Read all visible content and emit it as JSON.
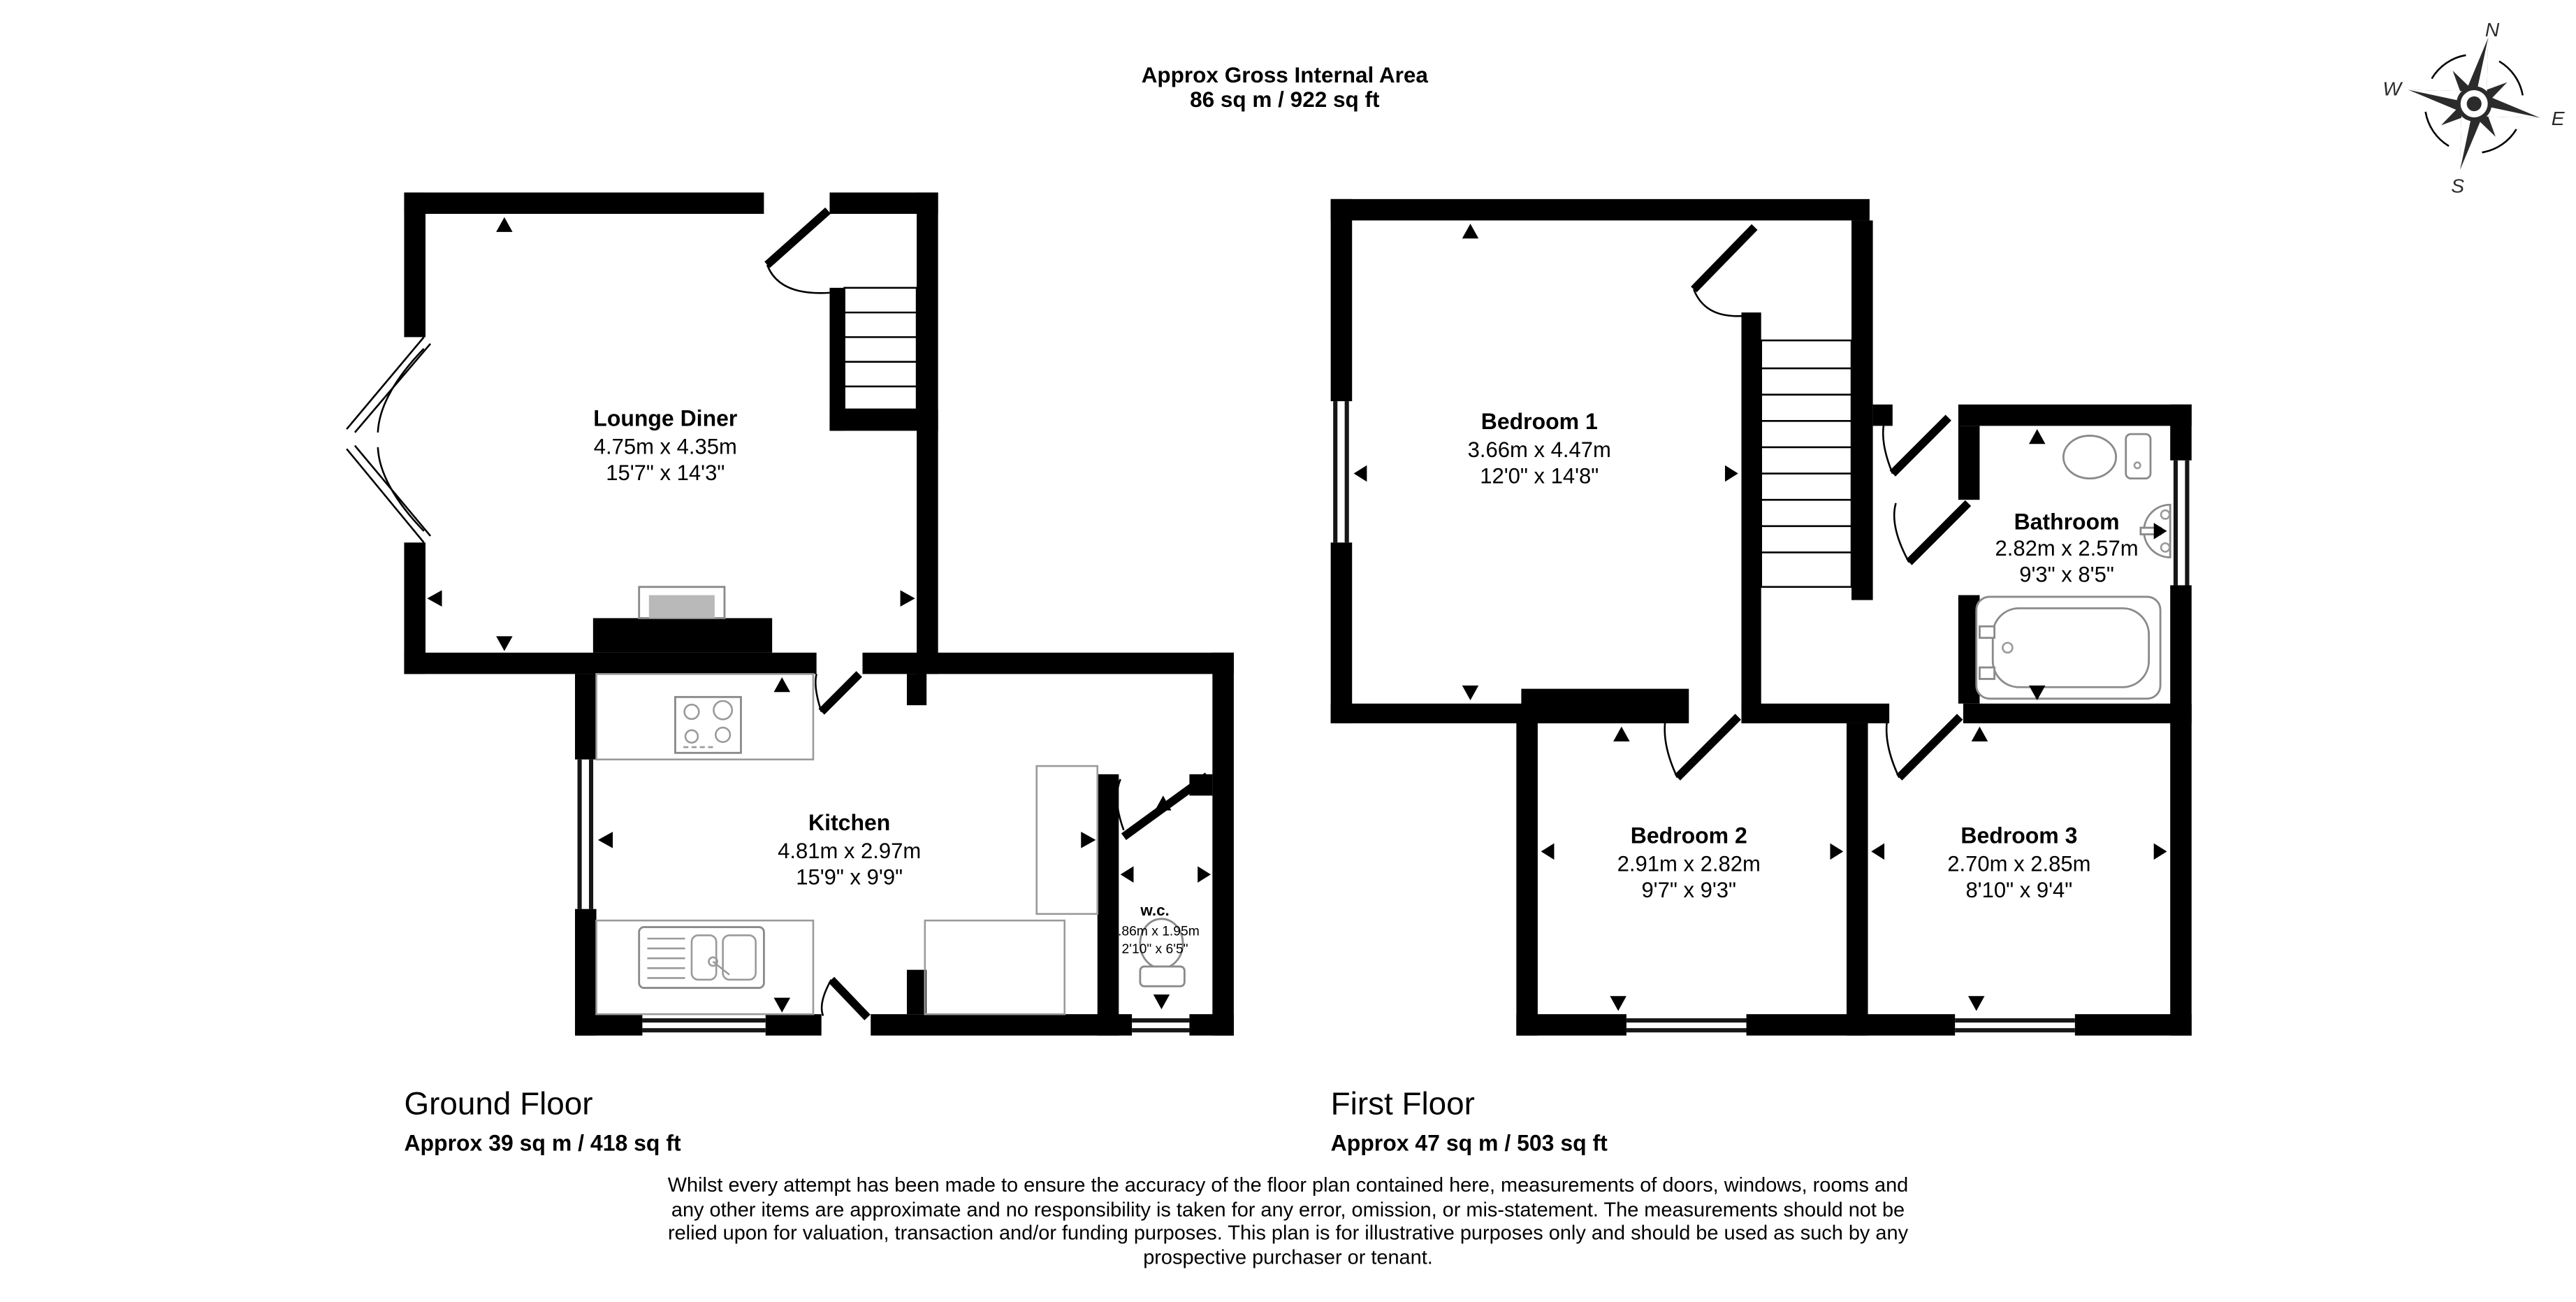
{
  "title": {
    "line1": "Approx Gross Internal Area",
    "line2": "86 sq m / 922 sq ft"
  },
  "compass": {
    "north": "N",
    "east": "E",
    "south": "S",
    "west": "W"
  },
  "ground_floor": {
    "label": "Ground Floor",
    "area": "Approx 39 sq m / 418 sq ft",
    "rooms": {
      "lounge_diner": {
        "name": "Lounge Diner",
        "size_metric": "4.75m x 4.35m",
        "size_imperial": "15'7\" x 14'3\""
      },
      "kitchen": {
        "name": "Kitchen",
        "size_metric": "4.81m x 2.97m",
        "size_imperial": "15'9\" x 9'9\""
      },
      "wc": {
        "name": "w.c.",
        "size_metric": "0.86m x 1.95m",
        "size_imperial": "2'10\" x 6'5\""
      }
    }
  },
  "first_floor": {
    "label": "First Floor",
    "area": "Approx 47 sq m / 503 sq ft",
    "rooms": {
      "bedroom1": {
        "name": "Bedroom 1",
        "size_metric": "3.66m x 4.47m",
        "size_imperial": "12'0\" x 14'8\""
      },
      "bathroom": {
        "name": "Bathroom",
        "size_metric": "2.82m x 2.57m",
        "size_imperial": "9'3\" x 8'5\""
      },
      "bedroom2": {
        "name": "Bedroom 2",
        "size_metric": "2.91m x 2.82m",
        "size_imperial": "9'7\" x 9'3\""
      },
      "bedroom3": {
        "name": "Bedroom 3",
        "size_metric": "2.70m x 2.85m",
        "size_imperial": "8'10\" x 9'4\""
      }
    }
  },
  "disclaimer": {
    "line1": "Whilst every attempt has been made to ensure the accuracy of the floor plan contained here, measurements of doors, windows, rooms and",
    "line2": "any other items are approximate and no responsibility is taken for any error, omission, or mis-statement. The measurements should not be",
    "line3": "relied upon for valuation, transaction and/or funding purposes. This plan is for illustrative purposes only and should be used as such by any",
    "line4": "prospective purchaser or tenant."
  }
}
